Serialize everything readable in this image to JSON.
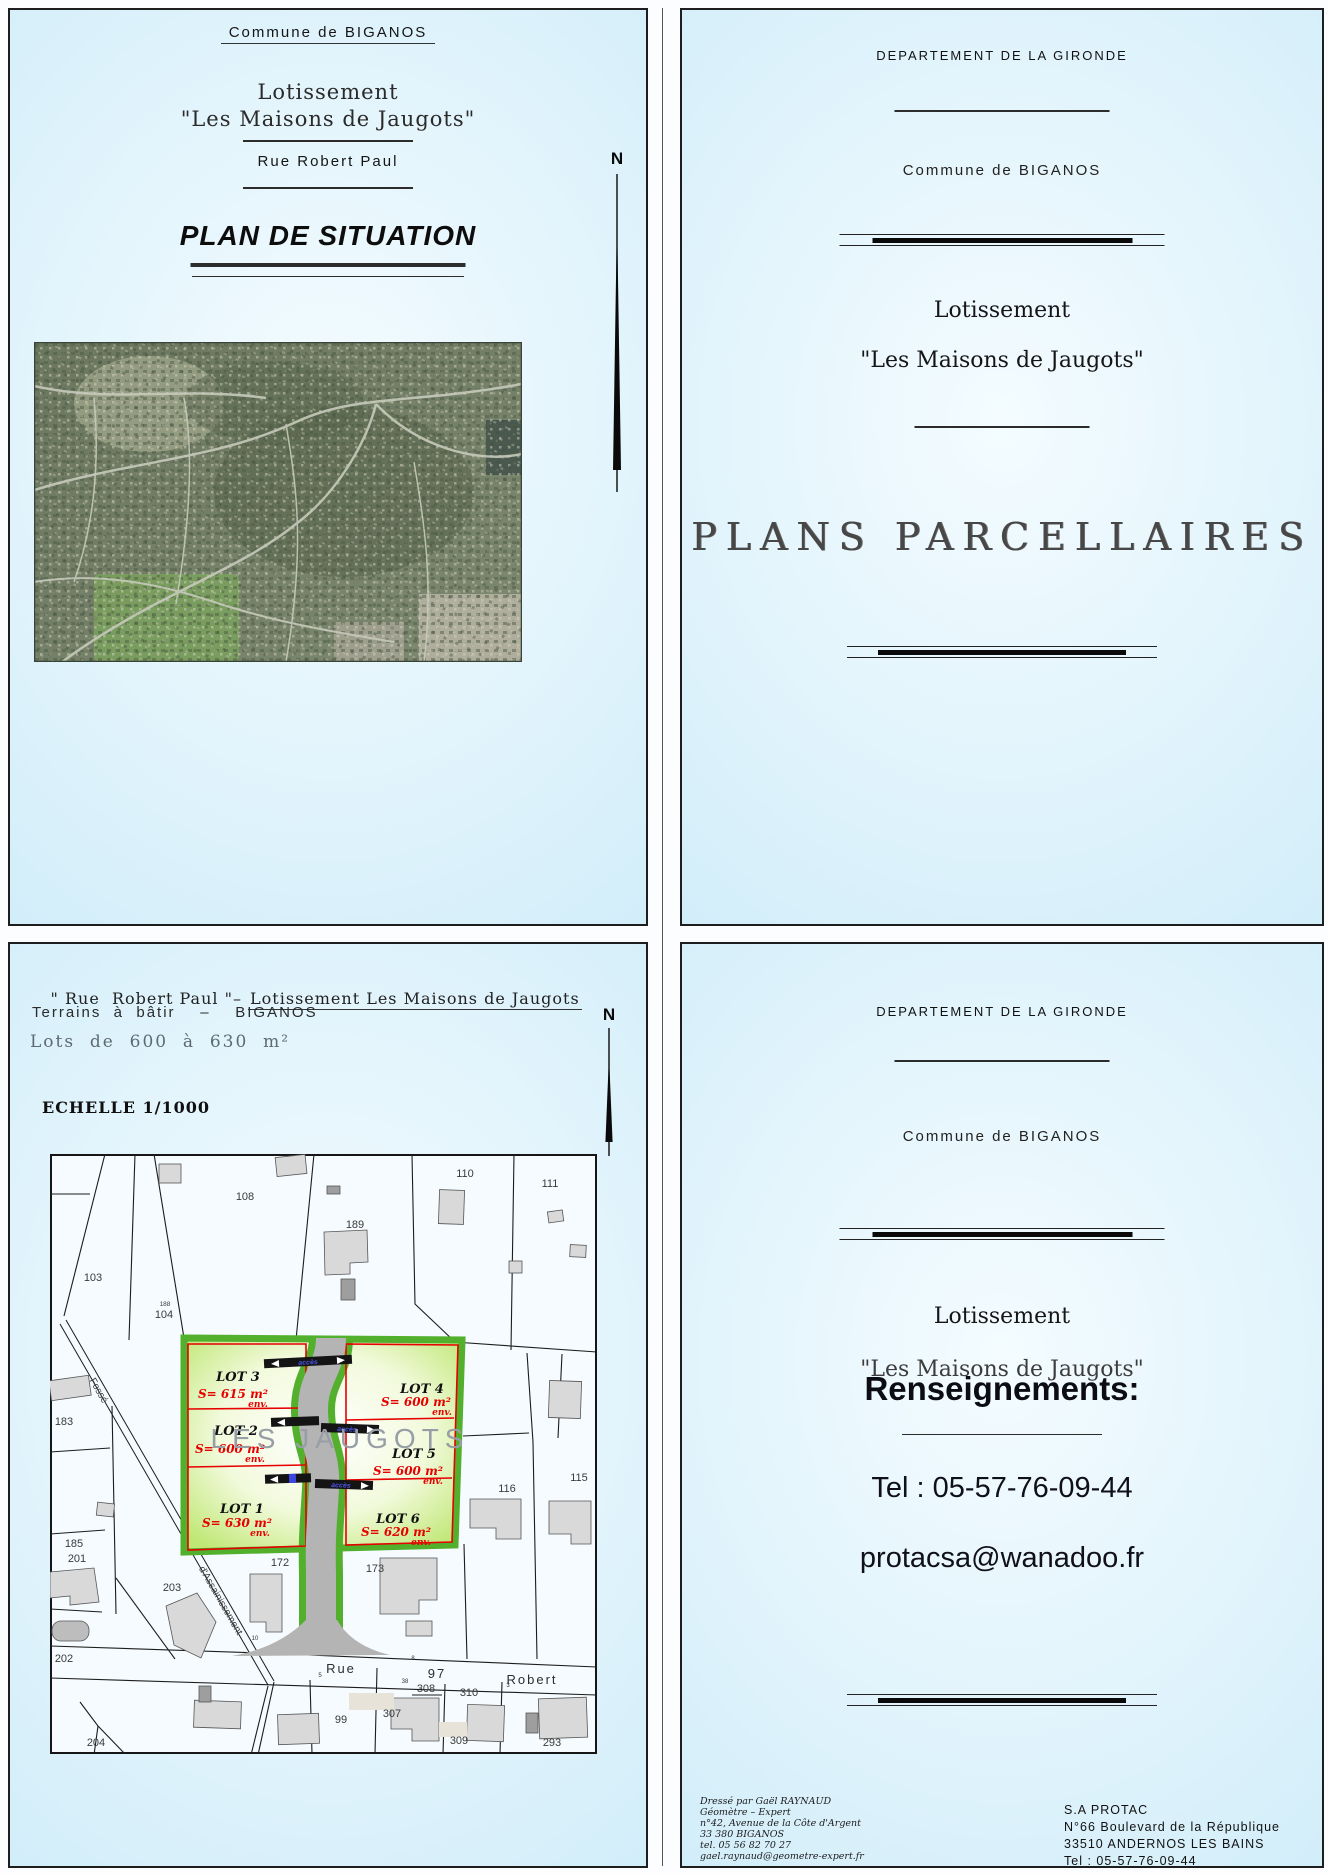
{
  "colors": {
    "panel_blue_edge": "#c4e8f7",
    "panel_blue_center": "#f4fcff",
    "lot_border_green": "#52b02c",
    "lot_line_red": "#e60000",
    "road_gray": "#b4b4b4",
    "building_gray": "#d9d9d9",
    "text_red": "#e60000"
  },
  "plan_situation": {
    "commune": "Commune de BIGANOS",
    "lotissement": "Lotissement",
    "lotissement_name": "\"Les Maisons de Jaugots\"",
    "street": "Rue  Robert Paul",
    "title": "PLAN DE SITUATION",
    "north_label": "N"
  },
  "plans_parcellaires": {
    "departement": "DEPARTEMENT DE LA GIRONDE",
    "commune": "Commune de BIGANOS",
    "lotissement": "Lotissement",
    "lotissement_name": "\"Les Maisons de Jaugots\"",
    "title": "PLANS  PARCELLAIRES"
  },
  "plan_detail": {
    "title_street": "\" Rue  Robert Paul \"– ",
    "title_lotissement": "Lotissement Les Maisons de Jaugots",
    "subtitle": "Terrains  à  bâtir    –    BIGANOS",
    "lots_line": "Lots  de  600  à  630  m²",
    "scale": "ECHELLE 1/1000",
    "north_label": "N",
    "road_label": "LES  JAUGOTS",
    "access_label": "accès",
    "fosse_label": "Fossé",
    "assainissement_label": "d'Assainissement",
    "street": {
      "rue": "Rue",
      "num": "97",
      "robert": "Robert"
    },
    "lots": [
      {
        "name": "LOT 1",
        "area": "S= 630 m²",
        "env": "env."
      },
      {
        "name": "LOT 2",
        "area": "S= 600 m²",
        "env": "env."
      },
      {
        "name": "LOT 3",
        "area": "S= 615 m²",
        "env": "env."
      },
      {
        "name": "LOT 4",
        "area": "S= 600 m²",
        "env": "env."
      },
      {
        "name": "LOT 5",
        "area": "S= 600 m²",
        "env": "env."
      },
      {
        "name": "LOT 6",
        "area": "S= 620 m²",
        "env": "env."
      }
    ],
    "parcels": {
      "p108": "108",
      "p189": "189",
      "p110": "110",
      "p111": "111",
      "p103": "103",
      "p104": "104",
      "p188": "188",
      "p183": "183",
      "p185": "185",
      "p201": "201",
      "p203": "203",
      "p172": "172",
      "p202": "202",
      "p204": "204",
      "p173": "173",
      "p116": "116",
      "p115": "115",
      "p99": "99",
      "p307": "307",
      "p308": "308",
      "p310": "310",
      "p309": "309",
      "p293": "293"
    },
    "ticks": {
      "t10": "10",
      "t8": "8",
      "t5": "5",
      "t38": "38",
      "t3": "3"
    }
  },
  "renseignements": {
    "departement": "DEPARTEMENT DE LA GIRONDE",
    "commune": "Commune de BIGANOS",
    "lotissement": "Lotissement",
    "lotissement_name": "\"Les Maisons de Jaugots\"",
    "heading": "Renseignements:",
    "tel": "Tel : 05-57-76-09-44",
    "email": "protacsa@wanadoo.fr",
    "surveyor": [
      "Dressé par Gaël RAYNAUD",
      "Géomètre – Expert",
      "n°42, Avenue de la Côte d'Argent",
      "33 380 BIGANOS",
      "tel. 05 56 82 70 27",
      "gael.raynaud@geometre-expert.fr"
    ],
    "company": [
      "S.A  PROTAC",
      "N°66  Boulevard  de  la  République",
      "33510  ANDERNOS  LES  BAINS",
      "Tel : 05-57-76-09-44"
    ]
  }
}
